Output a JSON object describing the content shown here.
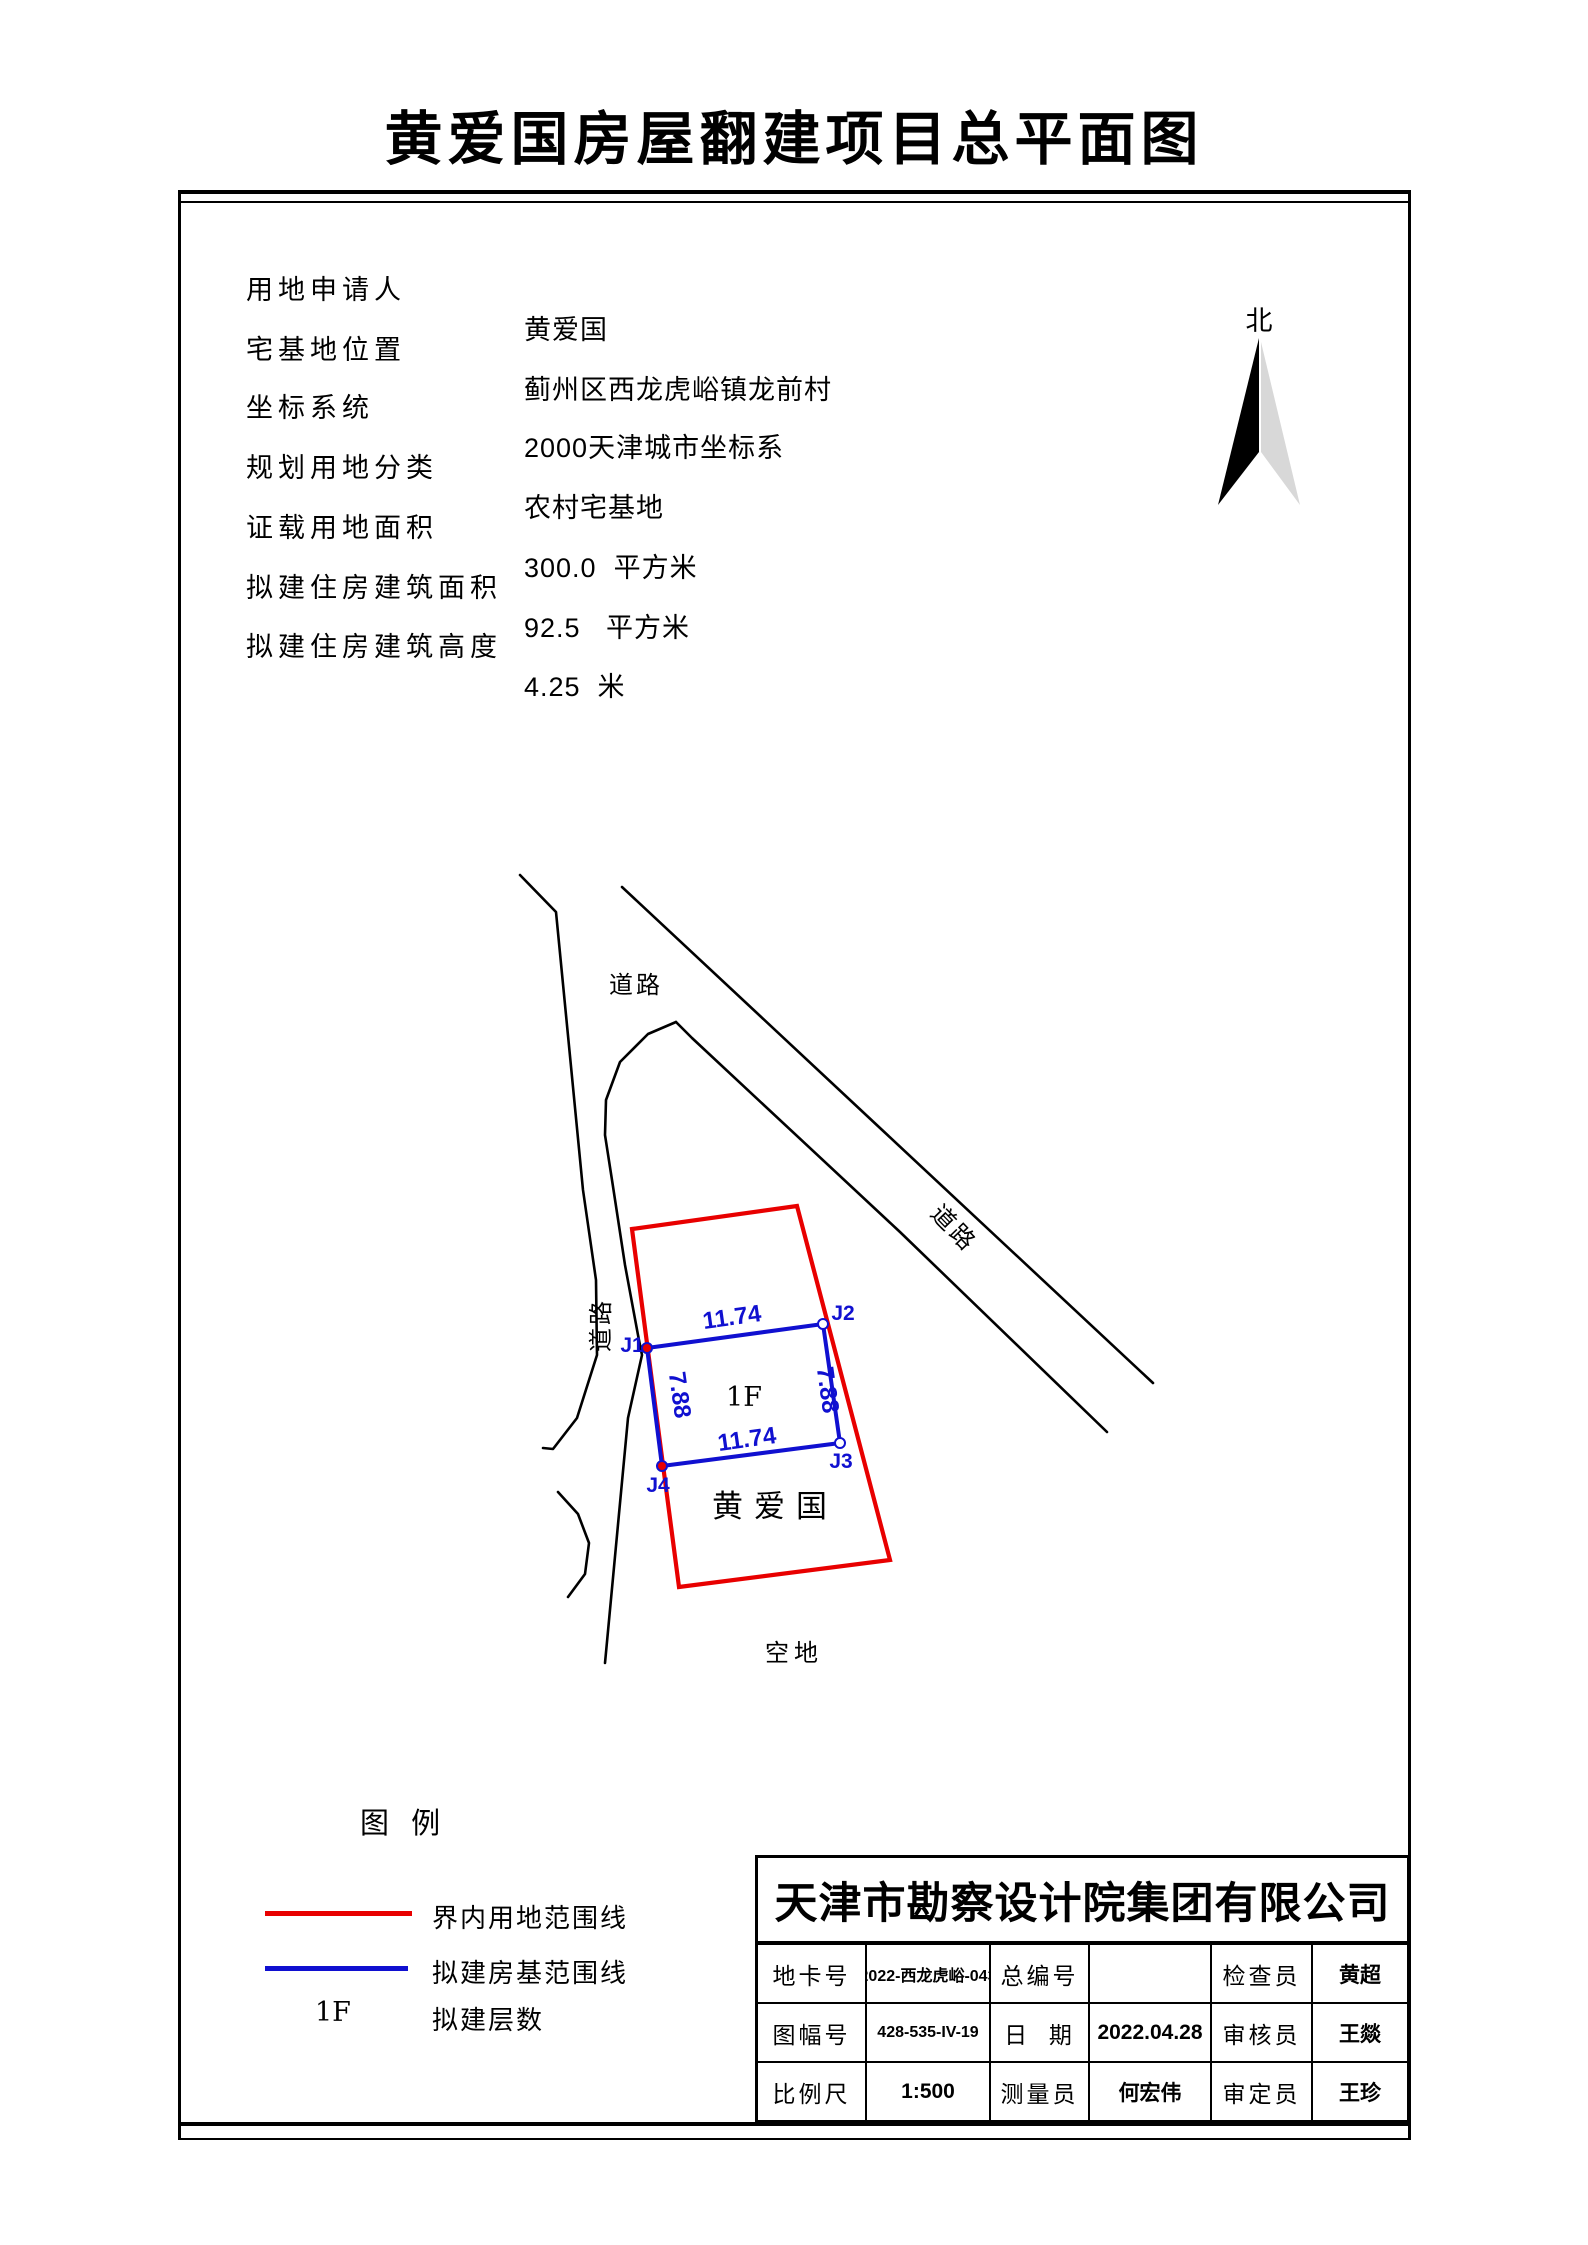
{
  "title": "黄爱国房屋翻建项目总平面图",
  "info": {
    "rows": [
      {
        "label": "用地申请人",
        "value": "黄爱国"
      },
      {
        "label": "宅基地位置",
        "value": "蓟州区西龙虎峪镇龙前村"
      },
      {
        "label": "坐标系统",
        "value": "2000天津城市坐标系"
      },
      {
        "label": "规划用地分类",
        "value": "农村宅基地"
      },
      {
        "label": "证载用地面积",
        "value": "300.0  平方米"
      },
      {
        "label": "拟建住房建筑面积",
        "value": "92.5   平方米"
      },
      {
        "label": "拟建住房建筑高度",
        "value": "4.25  米"
      }
    ]
  },
  "north": {
    "label": "北"
  },
  "plan": {
    "road_label_top": "道路",
    "road_label_left": "道路",
    "road_label_diagonal": "道路",
    "vacant_label": "空地",
    "owner_label": "黄爱国",
    "floors_label": "1F",
    "dim_top": "11.74",
    "dim_bottom": "11.74",
    "dim_left": "7.88",
    "dim_right": "7.88",
    "j1": "J1",
    "j2": "J2",
    "j3": "J3",
    "j4": "J4",
    "colors": {
      "boundary": "#e80000",
      "building": "#1010d0",
      "road": "#000000"
    }
  },
  "legend": {
    "title": "图  例",
    "items": [
      {
        "swatch": "red-line",
        "label": "界内用地范围线"
      },
      {
        "swatch": "blue-line",
        "label": "拟建房基范围线"
      },
      {
        "symbol": "1F",
        "label": "拟建层数"
      }
    ]
  },
  "titleblock": {
    "company": "天津市勘察设计院集团有限公司",
    "rows": [
      [
        {
          "label": "地卡号",
          "value": "2022-西龙虎峪-043"
        },
        {
          "label": "总编号",
          "value": ""
        },
        {
          "label": "检查员",
          "value": "黄超"
        }
      ],
      [
        {
          "label": "图幅号",
          "value": "428-535-IV-19"
        },
        {
          "label": "日  期",
          "value": "2022.04.28"
        },
        {
          "label": "审核员",
          "value": "王燚"
        }
      ],
      [
        {
          "label": "比例尺",
          "value": "1:500"
        },
        {
          "label": "测量员",
          "value": "何宏伟"
        },
        {
          "label": "审定员",
          "value": "王珍"
        }
      ]
    ]
  }
}
